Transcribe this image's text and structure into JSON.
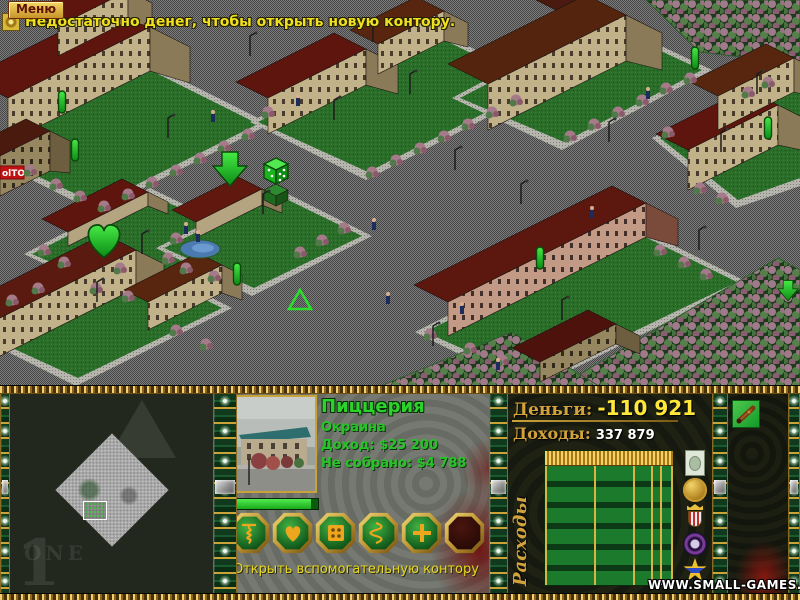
{
  "top_bar": {
    "menu_label": "Меню",
    "message": "Недостаточно денег, чтобы открыть новую контору."
  },
  "map": {
    "sign_label": "olTO"
  },
  "minimap": {
    "art_text": "ONE"
  },
  "business": {
    "name": "Пиццерия",
    "district": "Окраина",
    "income_label": "Доход:",
    "income_value": "$25 200",
    "uncollected_label": "Не собрано:",
    "uncollected_value": "$4 788",
    "hint": "Открыть вспомогательную контору",
    "buttons": [
      "corkscrew",
      "heart",
      "dice",
      "spring",
      "plus",
      "empty"
    ]
  },
  "finance": {
    "money_label": "Деньги:",
    "money_value": "-110 921",
    "income_label": "Доходы:",
    "income_value": "337 879",
    "expenses_label": "Расходы"
  },
  "watermark": "WWW.SMALL-GAMES.INFO",
  "colors": {
    "gold": "#d2a33c",
    "green_text": "#2bd32b",
    "yellow_text": "#e8d820",
    "money_value": "#ffe83a",
    "marker_green": "#2ae02a"
  }
}
